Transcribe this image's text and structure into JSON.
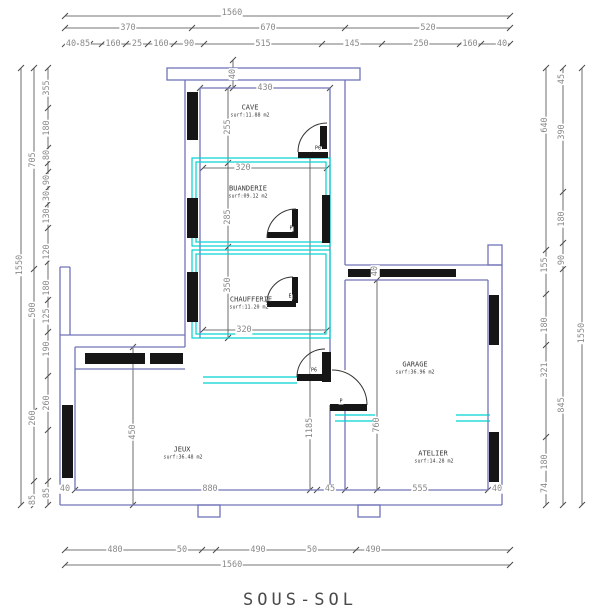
{
  "title": "SOUS-SOL",
  "colors": {
    "wall": "#7173b8",
    "partition": "#00d2d2",
    "dim_line": "#4a4a4a",
    "dim_text": "#8a8a8a",
    "block": "#161616"
  },
  "rooms": [
    {
      "name": "CAVE",
      "surface": "surf:11.88 m2"
    },
    {
      "name": "BUANDERIE",
      "surface": "surf:09.12 m2"
    },
    {
      "name": "CHAUFFERIE",
      "surface": "surf:11.20 m2"
    },
    {
      "name": "JEUX",
      "surface": "surf:36.48 m2"
    },
    {
      "name": "GARAGE",
      "surface": "surf:36.96 m2"
    },
    {
      "name": "ATELIER",
      "surface": "surf:14.28 m2"
    }
  ],
  "doors": [
    "P6",
    "P",
    "E",
    "P6",
    "P"
  ],
  "dims": {
    "top_row1": [
      "1560"
    ],
    "top_row2": [
      "370",
      "670",
      "520"
    ],
    "top_row3": [
      "40",
      "85",
      "160",
      "25",
      "160",
      "90",
      "515",
      "145",
      "250",
      "160",
      "40"
    ],
    "bottom_row1": [
      "480",
      "50",
      "490",
      "50",
      "490"
    ],
    "bottom_row2": [
      "1560"
    ],
    "left_col1": [
      "1550"
    ],
    "left_col2": [
      "705",
      "500",
      "260",
      "85"
    ],
    "left_col3": [
      "355",
      "180",
      "80",
      "90",
      "30",
      "130",
      "120",
      "180",
      "125",
      "190",
      "260",
      "85"
    ],
    "right_inner": [
      "640",
      "155",
      "180",
      "321",
      "180",
      "74"
    ],
    "right_mid": [
      "45",
      "390",
      "180",
      "90",
      "845"
    ],
    "right_outer": [
      "1550"
    ],
    "interior": {
      "cap": "40",
      "cave_width": "430",
      "cave_height": "255",
      "buanderie_width": "320",
      "buanderie_height": "285",
      "chaufferie_height": "350",
      "chaufferie_width": "320",
      "jeux_height": "450",
      "jeux_width": "880",
      "hall_height": "1185",
      "garage_height": "760",
      "garage_top": "40",
      "bottom": [
        "40",
        "880",
        "45",
        "555",
        "40"
      ]
    }
  }
}
